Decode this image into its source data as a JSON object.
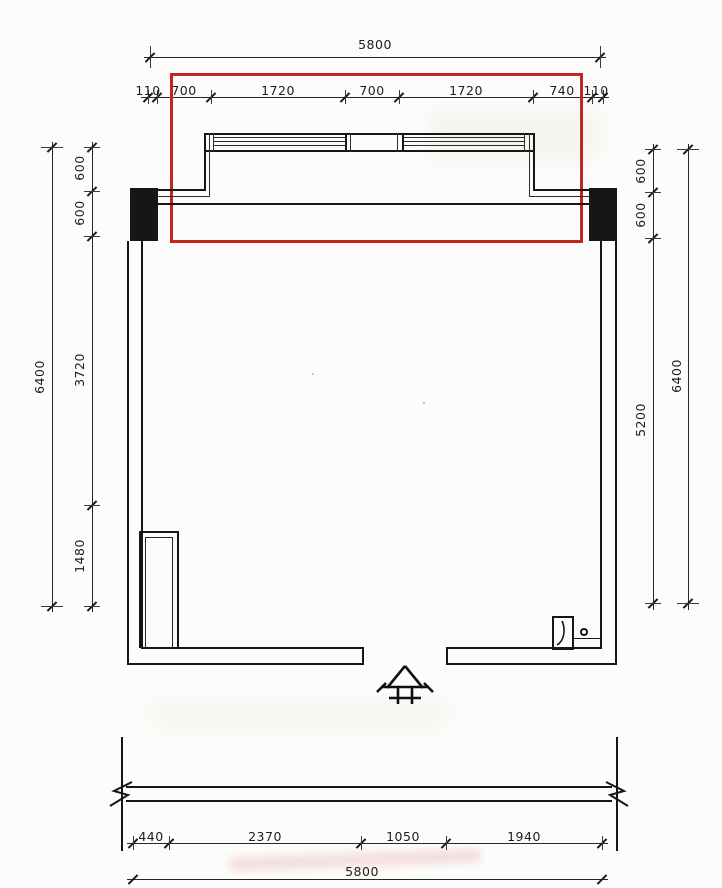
{
  "sheet": {
    "highlight_color": "#c3261e",
    "line_color": "#161616"
  },
  "dims": {
    "top": {
      "overall": "5800",
      "segments": [
        "110",
        "700",
        "1720",
        "700",
        "1720",
        "740",
        "110"
      ]
    },
    "left": {
      "overall": "6400",
      "segments": [
        "600",
        "600",
        "3720",
        "1480"
      ]
    },
    "right": {
      "overall": "6400",
      "segments": [
        "600",
        "600",
        "5200"
      ]
    },
    "bottom": {
      "overall": "5800",
      "segments": [
        "440",
        "2370",
        "1050",
        "1940"
      ]
    }
  }
}
